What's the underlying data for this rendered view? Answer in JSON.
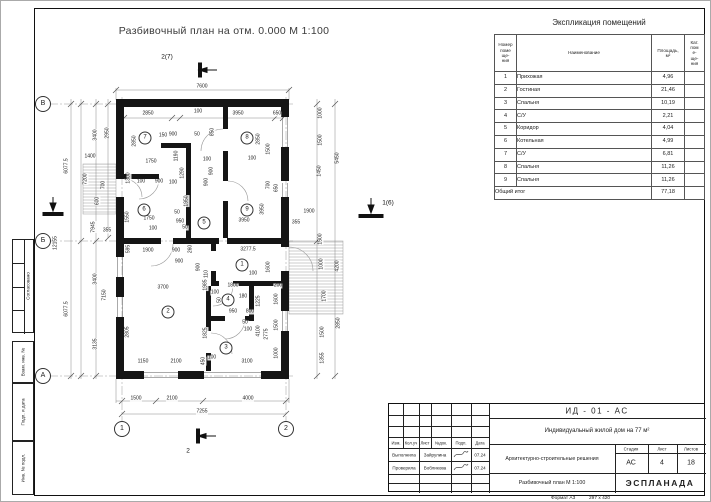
{
  "sheet": {
    "title": "Разбивочный план на отм. 0.000 М 1:100",
    "format_label": "Формат А3",
    "format_size": "297 х 420"
  },
  "schedule": {
    "title": "Экспликация помещений",
    "headers": {
      "num": "Номер\nпоме\nще-\nния",
      "name": "Наименование",
      "area": "Площадь,\nм²",
      "cat": "Кат.\nпом\nе-\nще-\nния"
    },
    "rows": [
      {
        "num": "1",
        "name": "Прихожая",
        "area": "4,96"
      },
      {
        "num": "2",
        "name": "Гостиная",
        "area": "21,46"
      },
      {
        "num": "3",
        "name": "Спальня",
        "area": "10,19"
      },
      {
        "num": "4",
        "name": "С/У",
        "area": "2,21"
      },
      {
        "num": "5",
        "name": "Коридор",
        "area": "4,04"
      },
      {
        "num": "6",
        "name": "Котельная",
        "area": "4,99"
      },
      {
        "num": "7",
        "name": "С/У",
        "area": "6,81"
      },
      {
        "num": "8",
        "name": "Спальня",
        "area": "11,26"
      },
      {
        "num": "9",
        "name": "Спальня",
        "area": "11,26"
      }
    ],
    "total_label": "Общий итог",
    "total_value": "77,18"
  },
  "title_block": {
    "doc_code": "ИД - 01 - АС",
    "project_name": "Индивидуальный жилой дом на 77 м²",
    "columns": [
      "Изм.",
      "Кол.уч",
      "Лист",
      "№док.",
      "Подп.",
      "Дата"
    ],
    "row_performed": {
      "role": "Выполнила",
      "name": "Зайрулина",
      "date": "07.24"
    },
    "row_checked": {
      "role": "Проверила",
      "name": "Вобликова",
      "date": "07.24"
    },
    "section_title": "Архитектурно-строительные решения",
    "stage_label": "Стадия",
    "sheet_label": "Лист",
    "sheets_label": "Листов",
    "stage": "АС",
    "sheet": "4",
    "sheets": "18",
    "drawing_title": "Разбивочный план М 1:100",
    "company": "ЭСПЛАНАДА"
  },
  "side_stamps": [
    {
      "label": "Согласовано"
    },
    {
      "label": "Взам. инв. №"
    },
    {
      "label": "Подп. и дата"
    },
    {
      "label": "Инв. № подл."
    }
  ],
  "plan": {
    "axes": [
      {
        "label": "В",
        "x": 42,
        "y": 103
      },
      {
        "label": "Б",
        "x": 42,
        "y": 240
      },
      {
        "label": "А",
        "x": 42,
        "y": 375
      },
      {
        "label": "1",
        "x": 121,
        "y": 428
      },
      {
        "label": "2",
        "x": 285,
        "y": 428
      }
    ],
    "rooms": [
      {
        "n": "1",
        "x": 241,
        "y": 264
      },
      {
        "n": "2",
        "x": 167,
        "y": 311
      },
      {
        "n": "3",
        "x": 225,
        "y": 347
      },
      {
        "n": "4",
        "x": 227,
        "y": 299
      },
      {
        "n": "5",
        "x": 203,
        "y": 222
      },
      {
        "n": "6",
        "x": 143,
        "y": 209
      },
      {
        "n": "7",
        "x": 144,
        "y": 137
      },
      {
        "n": "8",
        "x": 246,
        "y": 137
      },
      {
        "n": "9",
        "x": 246,
        "y": 209
      }
    ],
    "markers": [
      {
        "label": "2(7)",
        "x": 166,
        "y": 56
      },
      {
        "label": "2",
        "x": 187,
        "y": 450
      },
      {
        "label": "1(6)",
        "x": 387,
        "y": 202
      }
    ],
    "dims": [
      {
        "t": "7600",
        "x": 201,
        "y": 86
      },
      {
        "t": "2850",
        "x": 147,
        "y": 113
      },
      {
        "t": "100",
        "x": 197,
        "y": 111
      },
      {
        "t": "3950",
        "x": 237,
        "y": 113
      },
      {
        "t": "650",
        "x": 276,
        "y": 113
      },
      {
        "t": "6077.5",
        "x": 66,
        "y": 165,
        "r": 1
      },
      {
        "t": "12155",
        "x": 55,
        "y": 242,
        "r": 1
      },
      {
        "t": "6077.5",
        "x": 66,
        "y": 308,
        "r": 1
      },
      {
        "t": "3400",
        "x": 95,
        "y": 134,
        "r": 1
      },
      {
        "t": "2950",
        "x": 107,
        "y": 132,
        "r": 1
      },
      {
        "t": "1400",
        "x": 89,
        "y": 156
      },
      {
        "t": "7200",
        "x": 85,
        "y": 178,
        "r": 1
      },
      {
        "t": "700",
        "x": 103,
        "y": 184,
        "r": 1
      },
      {
        "t": "600",
        "x": 97,
        "y": 200,
        "r": 1
      },
      {
        "t": "7945",
        "x": 93,
        "y": 226,
        "r": 1
      },
      {
        "t": "355",
        "x": 106,
        "y": 230
      },
      {
        "t": "3400",
        "x": 95,
        "y": 278,
        "r": 1
      },
      {
        "t": "7150",
        "x": 104,
        "y": 294,
        "r": 1
      },
      {
        "t": "3135",
        "x": 95,
        "y": 343,
        "r": 1
      },
      {
        "t": "1000",
        "x": 320,
        "y": 112,
        "r": 1
      },
      {
        "t": "1500",
        "x": 320,
        "y": 139,
        "r": 1
      },
      {
        "t": "1450",
        "x": 319,
        "y": 170,
        "r": 1
      },
      {
        "t": "5450",
        "x": 337,
        "y": 157,
        "r": 1
      },
      {
        "t": "1900",
        "x": 308,
        "y": 211
      },
      {
        "t": "355",
        "x": 295,
        "y": 222
      },
      {
        "t": "1500",
        "x": 320,
        "y": 238,
        "r": 1
      },
      {
        "t": "1000",
        "x": 321,
        "y": 263,
        "r": 1
      },
      {
        "t": "4200",
        "x": 337,
        "y": 265,
        "r": 1
      },
      {
        "t": "1700",
        "x": 324,
        "y": 295,
        "r": 1
      },
      {
        "t": "2850",
        "x": 338,
        "y": 322,
        "r": 1
      },
      {
        "t": "1500",
        "x": 322,
        "y": 331,
        "r": 1
      },
      {
        "t": "1355",
        "x": 322,
        "y": 357,
        "r": 1
      },
      {
        "t": "1500",
        "x": 135,
        "y": 398
      },
      {
        "t": "2100",
        "x": 171,
        "y": 398
      },
      {
        "t": "4000",
        "x": 247,
        "y": 398
      },
      {
        "t": "7255",
        "x": 201,
        "y": 411
      },
      {
        "t": "2850",
        "x": 134,
        "y": 140,
        "r": 1
      },
      {
        "t": "2850",
        "x": 258,
        "y": 138,
        "r": 1
      },
      {
        "t": "850",
        "x": 212,
        "y": 131,
        "r": 1
      },
      {
        "t": "150",
        "x": 162,
        "y": 135
      },
      {
        "t": "900",
        "x": 172,
        "y": 134
      },
      {
        "t": "50",
        "x": 196,
        "y": 134
      },
      {
        "t": "1750",
        "x": 150,
        "y": 161
      },
      {
        "t": "1190",
        "x": 176,
        "y": 155,
        "r": 1
      },
      {
        "t": "1290",
        "x": 182,
        "y": 172,
        "r": 1
      },
      {
        "t": "100",
        "x": 206,
        "y": 159
      },
      {
        "t": "900",
        "x": 211,
        "y": 170,
        "r": 1
      },
      {
        "t": "100",
        "x": 251,
        "y": 158
      },
      {
        "t": "1500",
        "x": 268,
        "y": 148,
        "r": 1
      },
      {
        "t": "700",
        "x": 268,
        "y": 184,
        "r": 1
      },
      {
        "t": "1300",
        "x": 128,
        "y": 177,
        "r": 1
      },
      {
        "t": "100",
        "x": 140,
        "y": 181
      },
      {
        "t": "900",
        "x": 158,
        "y": 181
      },
      {
        "t": "100",
        "x": 172,
        "y": 182
      },
      {
        "t": "900",
        "x": 206,
        "y": 181,
        "r": 1
      },
      {
        "t": "1950",
        "x": 186,
        "y": 200,
        "r": 1
      },
      {
        "t": "1550",
        "x": 127,
        "y": 216,
        "r": 1
      },
      {
        "t": "1750",
        "x": 148,
        "y": 218
      },
      {
        "t": "50",
        "x": 176,
        "y": 212
      },
      {
        "t": "950",
        "x": 179,
        "y": 221
      },
      {
        "t": "100",
        "x": 152,
        "y": 228
      },
      {
        "t": "50",
        "x": 184,
        "y": 227
      },
      {
        "t": "3950",
        "x": 243,
        "y": 220
      },
      {
        "t": "3950",
        "x": 262,
        "y": 208,
        "r": 1
      },
      {
        "t": "650",
        "x": 276,
        "y": 187,
        "r": 1
      },
      {
        "t": "595",
        "x": 128,
        "y": 248,
        "r": 1
      },
      {
        "t": "1900",
        "x": 147,
        "y": 250
      },
      {
        "t": "900",
        "x": 175,
        "y": 250
      },
      {
        "t": "260",
        "x": 190,
        "y": 248,
        "r": 1
      },
      {
        "t": "3277.5",
        "x": 247,
        "y": 249
      },
      {
        "t": "900",
        "x": 178,
        "y": 261
      },
      {
        "t": "900",
        "x": 198,
        "y": 266,
        "r": 1
      },
      {
        "t": "110",
        "x": 206,
        "y": 273,
        "r": 1
      },
      {
        "t": "1600",
        "x": 268,
        "y": 266,
        "r": 1
      },
      {
        "t": "100",
        "x": 252,
        "y": 273
      },
      {
        "t": "3700",
        "x": 162,
        "y": 287
      },
      {
        "t": "1985",
        "x": 205,
        "y": 284,
        "r": 1
      },
      {
        "t": "1800",
        "x": 232,
        "y": 285
      },
      {
        "t": "200",
        "x": 277,
        "y": 285
      },
      {
        "t": "100",
        "x": 214,
        "y": 292
      },
      {
        "t": "1225",
        "x": 258,
        "y": 300,
        "r": 1
      },
      {
        "t": "1600",
        "x": 276,
        "y": 298,
        "r": 1
      },
      {
        "t": "50",
        "x": 219,
        "y": 299,
        "r": 1
      },
      {
        "t": "180",
        "x": 242,
        "y": 296
      },
      {
        "t": "950",
        "x": 232,
        "y": 311
      },
      {
        "t": "800",
        "x": 249,
        "y": 311
      },
      {
        "t": "50",
        "x": 244,
        "y": 322
      },
      {
        "t": "100",
        "x": 247,
        "y": 329
      },
      {
        "t": "4100",
        "x": 258,
        "y": 330,
        "r": 1
      },
      {
        "t": "2775",
        "x": 266,
        "y": 333,
        "r": 1
      },
      {
        "t": "2805",
        "x": 127,
        "y": 331,
        "r": 1
      },
      {
        "t": "1825",
        "x": 205,
        "y": 332,
        "r": 1
      },
      {
        "t": "1500",
        "x": 276,
        "y": 324,
        "r": 1
      },
      {
        "t": "1000",
        "x": 276,
        "y": 352,
        "r": 1
      },
      {
        "t": "1150",
        "x": 142,
        "y": 361
      },
      {
        "t": "2100",
        "x": 175,
        "y": 361
      },
      {
        "t": "450",
        "x": 203,
        "y": 360,
        "r": 1
      },
      {
        "t": "100",
        "x": 211,
        "y": 357
      },
      {
        "t": "3100",
        "x": 246,
        "y": 361
      }
    ]
  }
}
